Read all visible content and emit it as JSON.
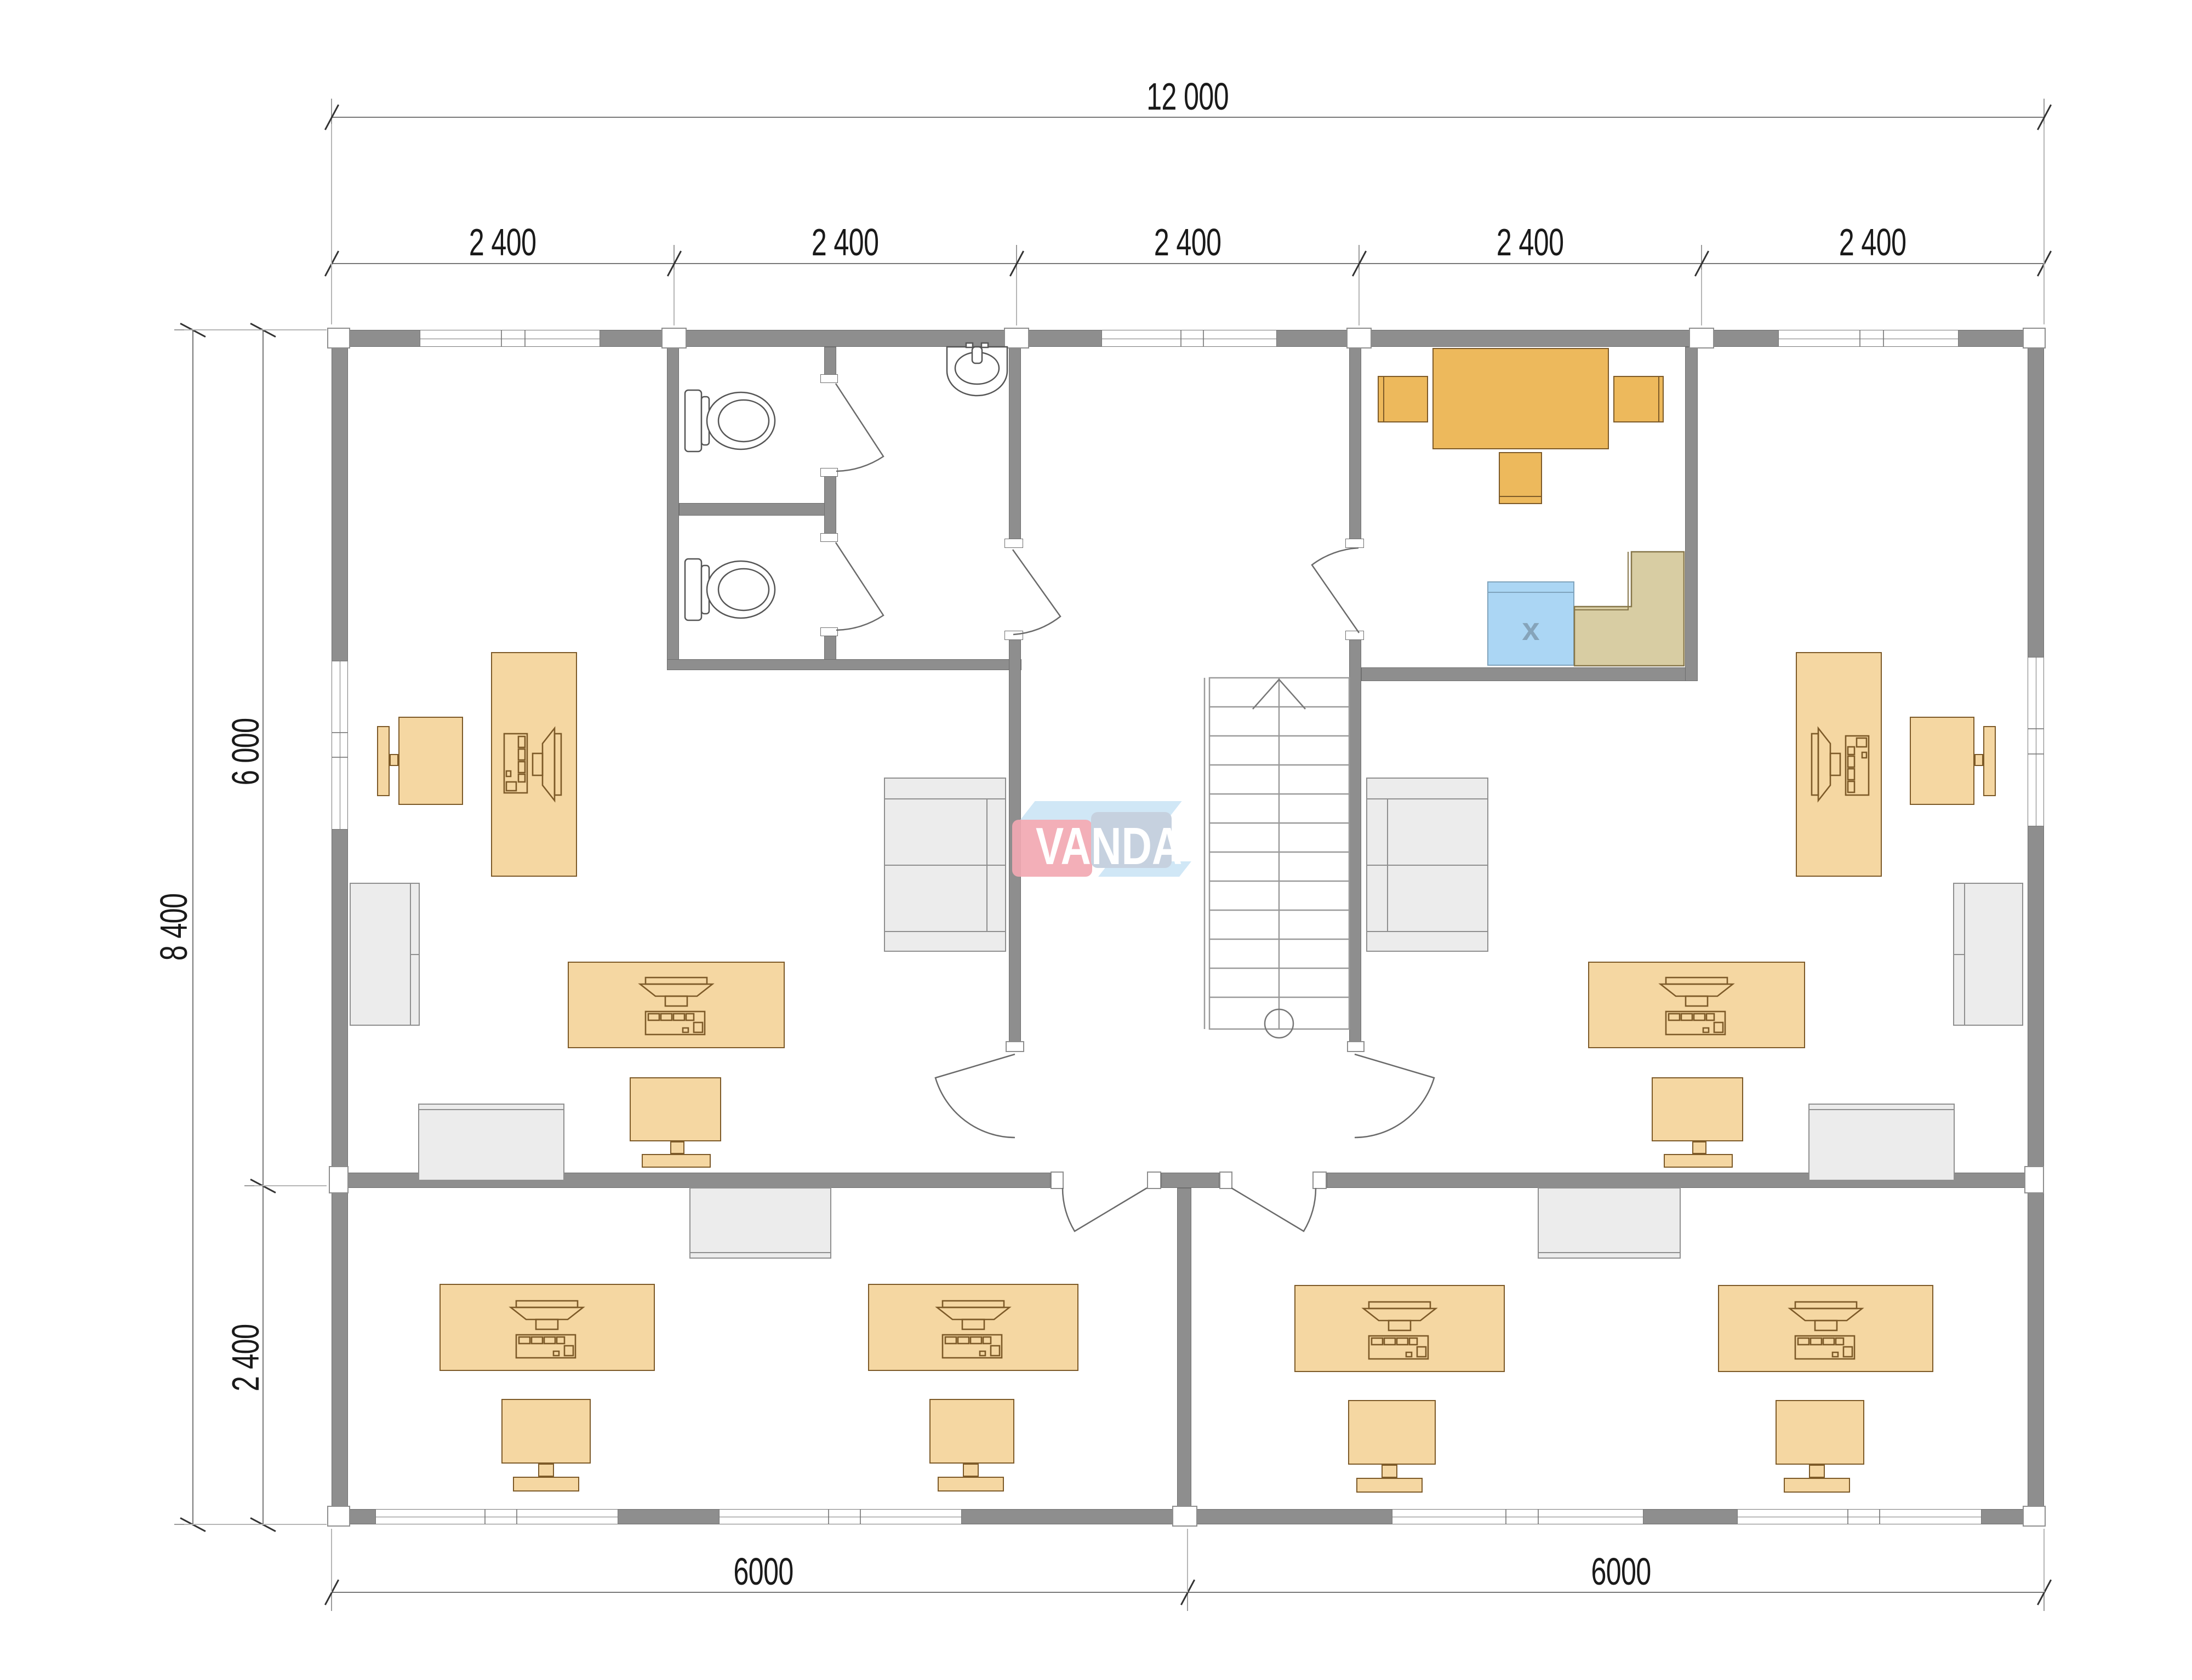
{
  "watermark": {
    "text": "VANDA"
  },
  "dimensions": {
    "top_total": "12 000",
    "bays": [
      "2 400",
      "2 400",
      "2 400",
      "2 400",
      "2 400"
    ],
    "left_total": "8 400",
    "left_upper": "6 000",
    "left_lower": "2 400",
    "bottom_spans": [
      "6000",
      "6000"
    ]
  },
  "kitchen": {
    "sink_label": "x"
  },
  "colors": {
    "wall": "#8E8E8E",
    "wall_edge": "#6E6E6E",
    "furniture_fill": "#F5D7A2",
    "furniture_stroke": "#7D5A28",
    "table_fill": "#EDB95C",
    "gray_fill": "#ECECEC",
    "gray_stroke": "#8F8F8F",
    "counter_fill": "#D8CDA3",
    "counter_stroke": "#86764A",
    "sink_fill": "#ABD6F4",
    "sink_stroke": "#7FA3BC",
    "logo_red": "#F2A9B3",
    "logo_blue": "#C2CEDD",
    "ink": "#1A1A1A",
    "line": "#777777"
  }
}
